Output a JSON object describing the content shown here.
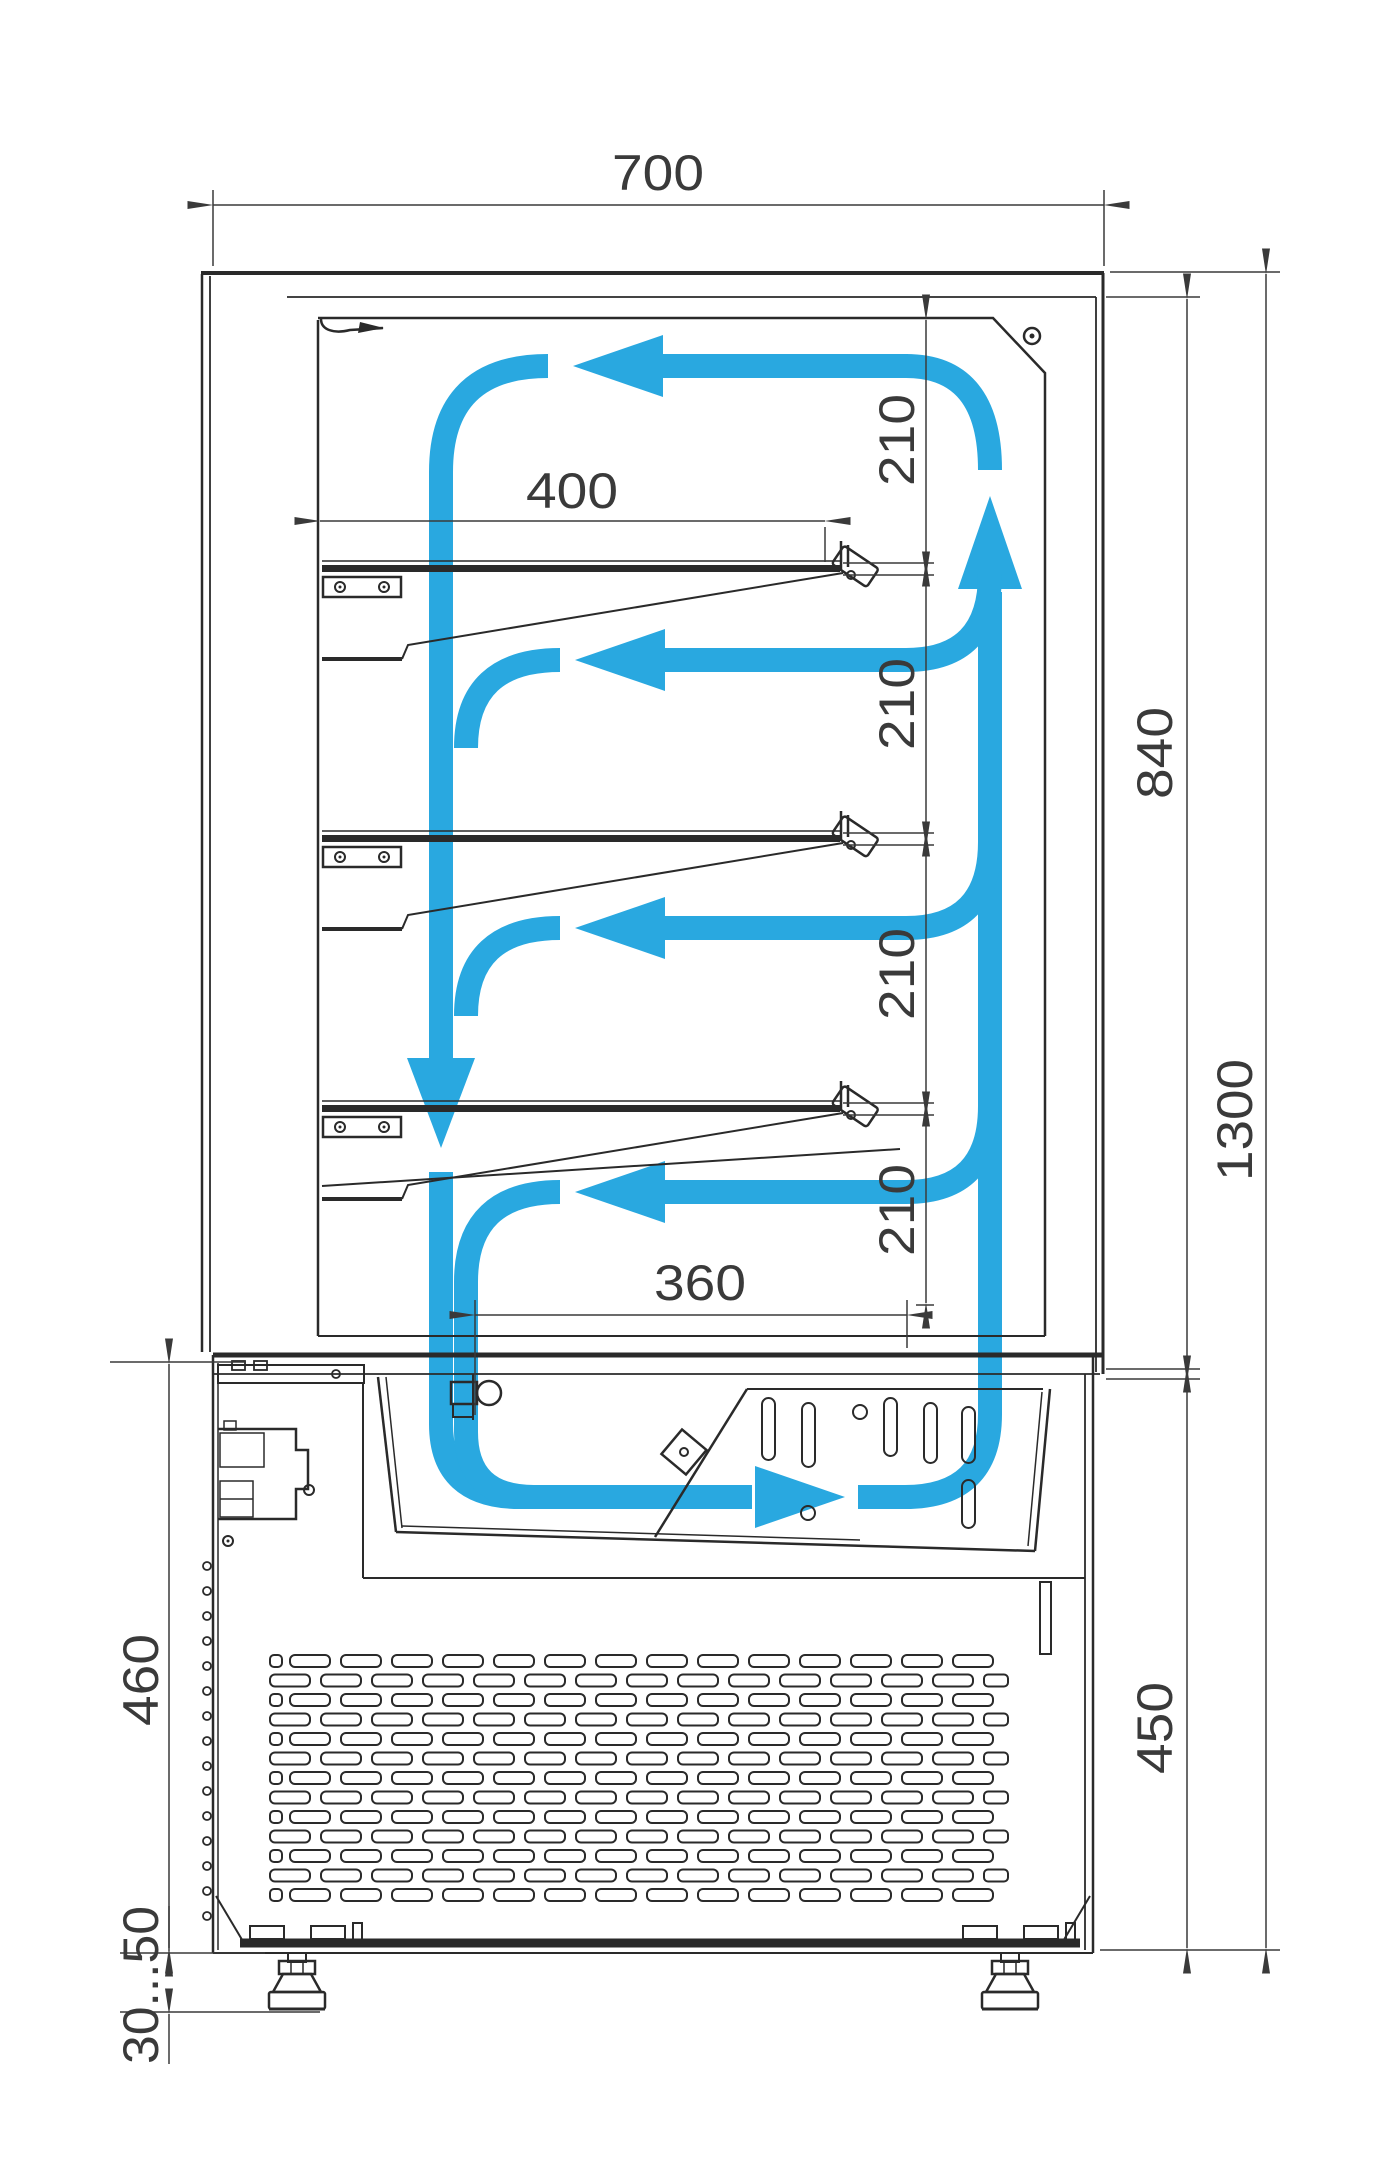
{
  "colors": {
    "airflow": "#29a8e0",
    "structure": "#2a2a2a",
    "dimension": "#3a3a3a",
    "background": "#ffffff"
  },
  "dims": {
    "width_top": "700",
    "shelf_depth": "400",
    "gap1": "210",
    "gap2": "210",
    "gap3": "210",
    "gap4": "210",
    "interior_height": "840",
    "overall_height": "1300",
    "intake_width": "360",
    "base_height_right": "450",
    "base_height_left": "460",
    "foot_range": "30...50"
  },
  "grille": {
    "rows": 13,
    "row_pitch": 19.5,
    "x_start": 270,
    "x_end": 1008,
    "slot_h": 12
  },
  "shelves": {
    "count": 3,
    "y_positions": [
      565,
      835,
      1105
    ]
  },
  "airflow_levels": {
    "run_y": [
      660,
      928,
      1192
    ]
  }
}
